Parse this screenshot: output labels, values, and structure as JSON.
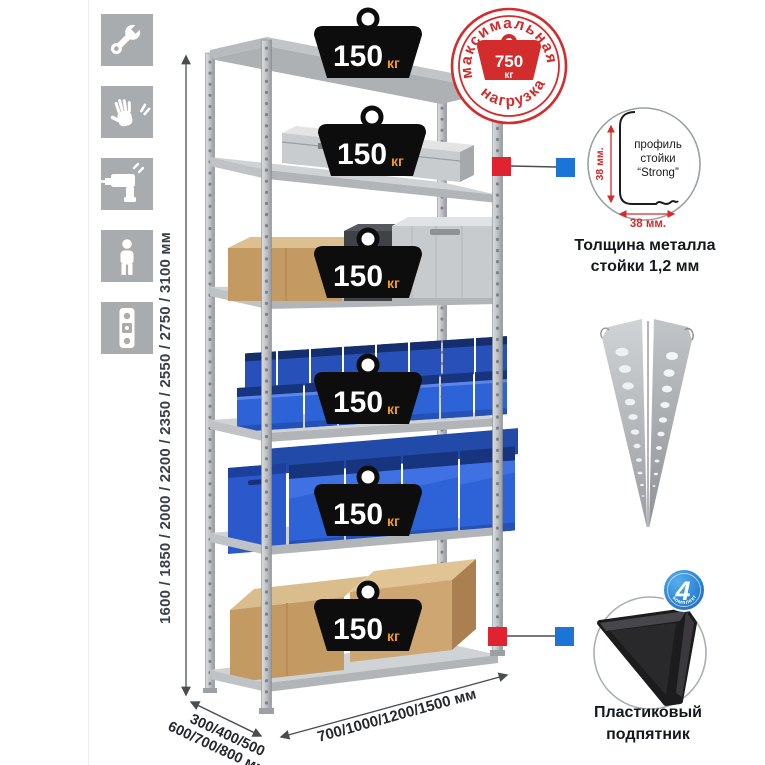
{
  "meta": {
    "description": "Product infographic of a metal boltless shelving rack with load ratings and dimensions",
    "background": "#ffffff"
  },
  "sidebar": {
    "icons": [
      {
        "name": "wrench"
      },
      {
        "name": "gloves"
      },
      {
        "name": "drill"
      },
      {
        "name": "person"
      },
      {
        "name": "level"
      }
    ],
    "tile_color": "#a9acaf"
  },
  "dimensions": {
    "height_label": "1600 / 1850 / 2000 / 2200 / 2350 / 2550 / 2750 / 3100 мм",
    "depth_label_line1": "300/400/500",
    "depth_label_line2": "600/700/800 мм",
    "width_label": "700/1000/1200/1500 мм"
  },
  "rack": {
    "shelf_count": 6,
    "shelves": [
      {
        "load": "150",
        "unit": "кг"
      },
      {
        "load": "150",
        "unit": "кг"
      },
      {
        "load": "150",
        "unit": "кг"
      },
      {
        "load": "150",
        "unit": "кг"
      },
      {
        "load": "150",
        "unit": "кг"
      },
      {
        "load": "150",
        "unit": "кг"
      }
    ]
  },
  "max_load_stamp": {
    "arc_top": "максимальная",
    "arc_bottom": "нагрузка",
    "value": "750",
    "unit": "кг",
    "color": "#d22c2c"
  },
  "profile_detail": {
    "label_line1": "профиль",
    "label_line2": "стойки",
    "label_line3": "“Strong”",
    "dim_vertical": "38 мм.",
    "dim_horizontal": "38 мм.",
    "caption_line1": "Толщина металла",
    "caption_line2": "стойки 1,2 мм"
  },
  "foot_detail": {
    "badge_value": "4",
    "badge_text": "в комплекте",
    "badge_color": "#1266c0",
    "caption_line1": "Пластиковый",
    "caption_line2": "подпятник"
  },
  "markers": {
    "red": "#e0232e",
    "blue": "#1b74d6"
  },
  "palette": {
    "bin_blue": "#2e63d8",
    "cardboard": "#c49a63",
    "metal": "#c3c6c9",
    "weight_black": "#0d0d0d",
    "weight_unit_orange": "#f39a1d"
  }
}
